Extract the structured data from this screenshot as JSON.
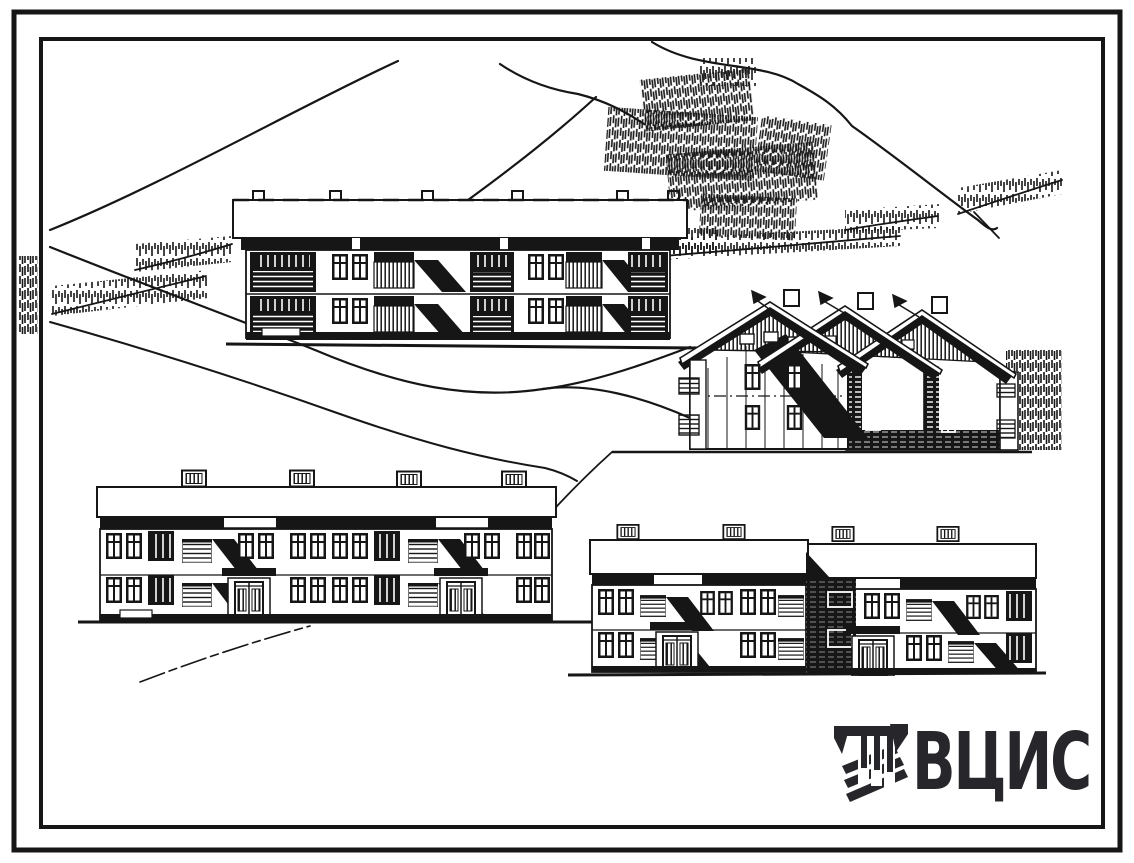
{
  "sheet": {
    "kind": "scanned architectural elevation drawing",
    "colors": {
      "paper": "#ffffff",
      "ink": "#161616",
      "logo": "#27272b"
    }
  },
  "logo": {
    "icon": "vcis-monogram-icon",
    "text": "ВЦИС",
    "color": "#27272b"
  }
}
